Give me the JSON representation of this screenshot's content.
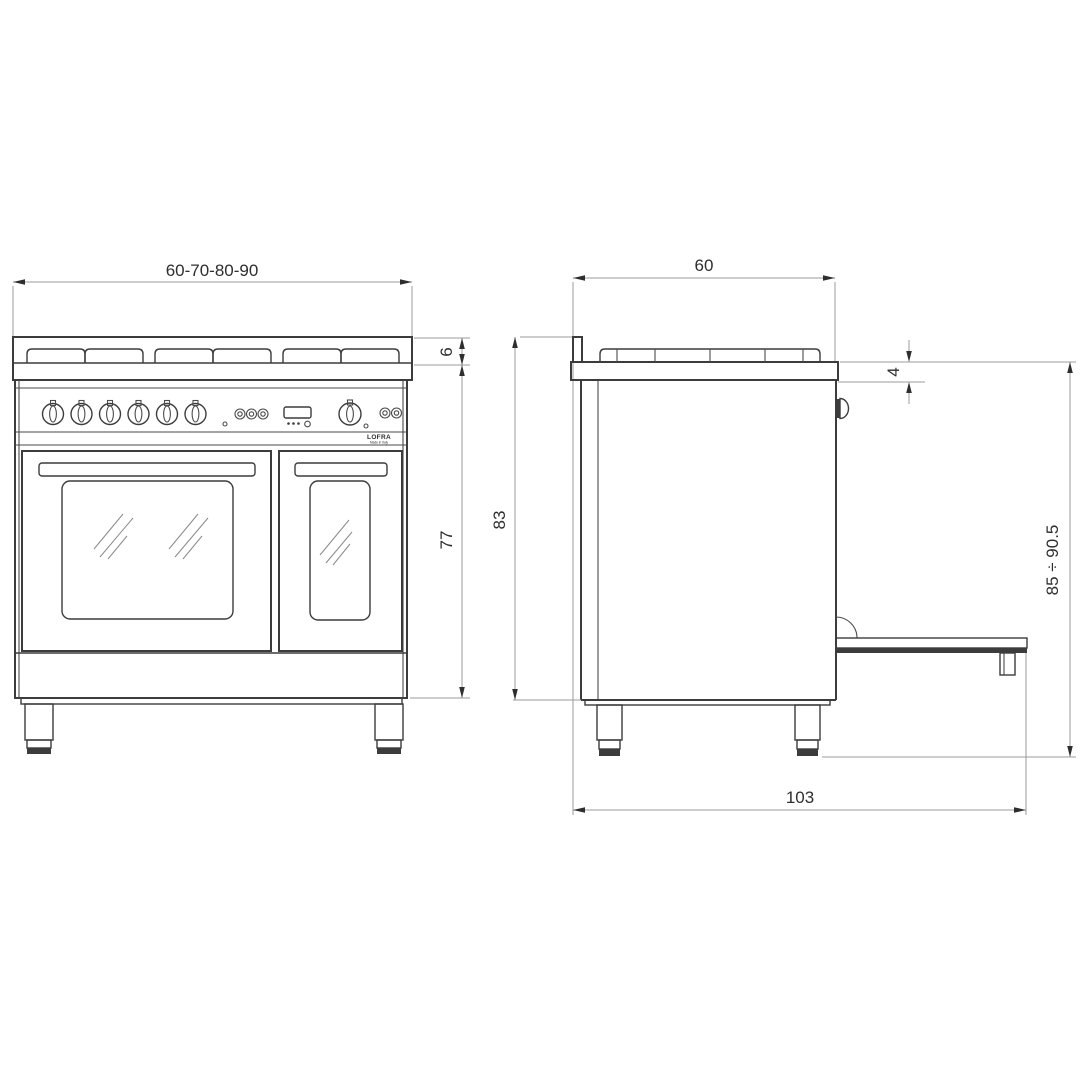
{
  "drawing": {
    "type": "appliance dimensional drawing",
    "subject": "double-oven range cooker, front and side elevation",
    "units_shown": "cm"
  },
  "front_view": {
    "dims": {
      "width": "60-70-80-90",
      "hob_edge_height": "6",
      "body_height": "77"
    },
    "logo": {
      "brand": "LOFRA",
      "origin": "Made in Italy"
    }
  },
  "side_view": {
    "dims": {
      "depth": "60",
      "body_height": "83",
      "worktop_thickness": "4",
      "overall_height_range": "85 ÷ 90.5",
      "depth_door_open": "103"
    }
  },
  "colors": {
    "background": "#ffffff",
    "outline": "#3c3c3c",
    "dimension_lines": "#9b9b9b",
    "text": "#2e2e2e"
  }
}
